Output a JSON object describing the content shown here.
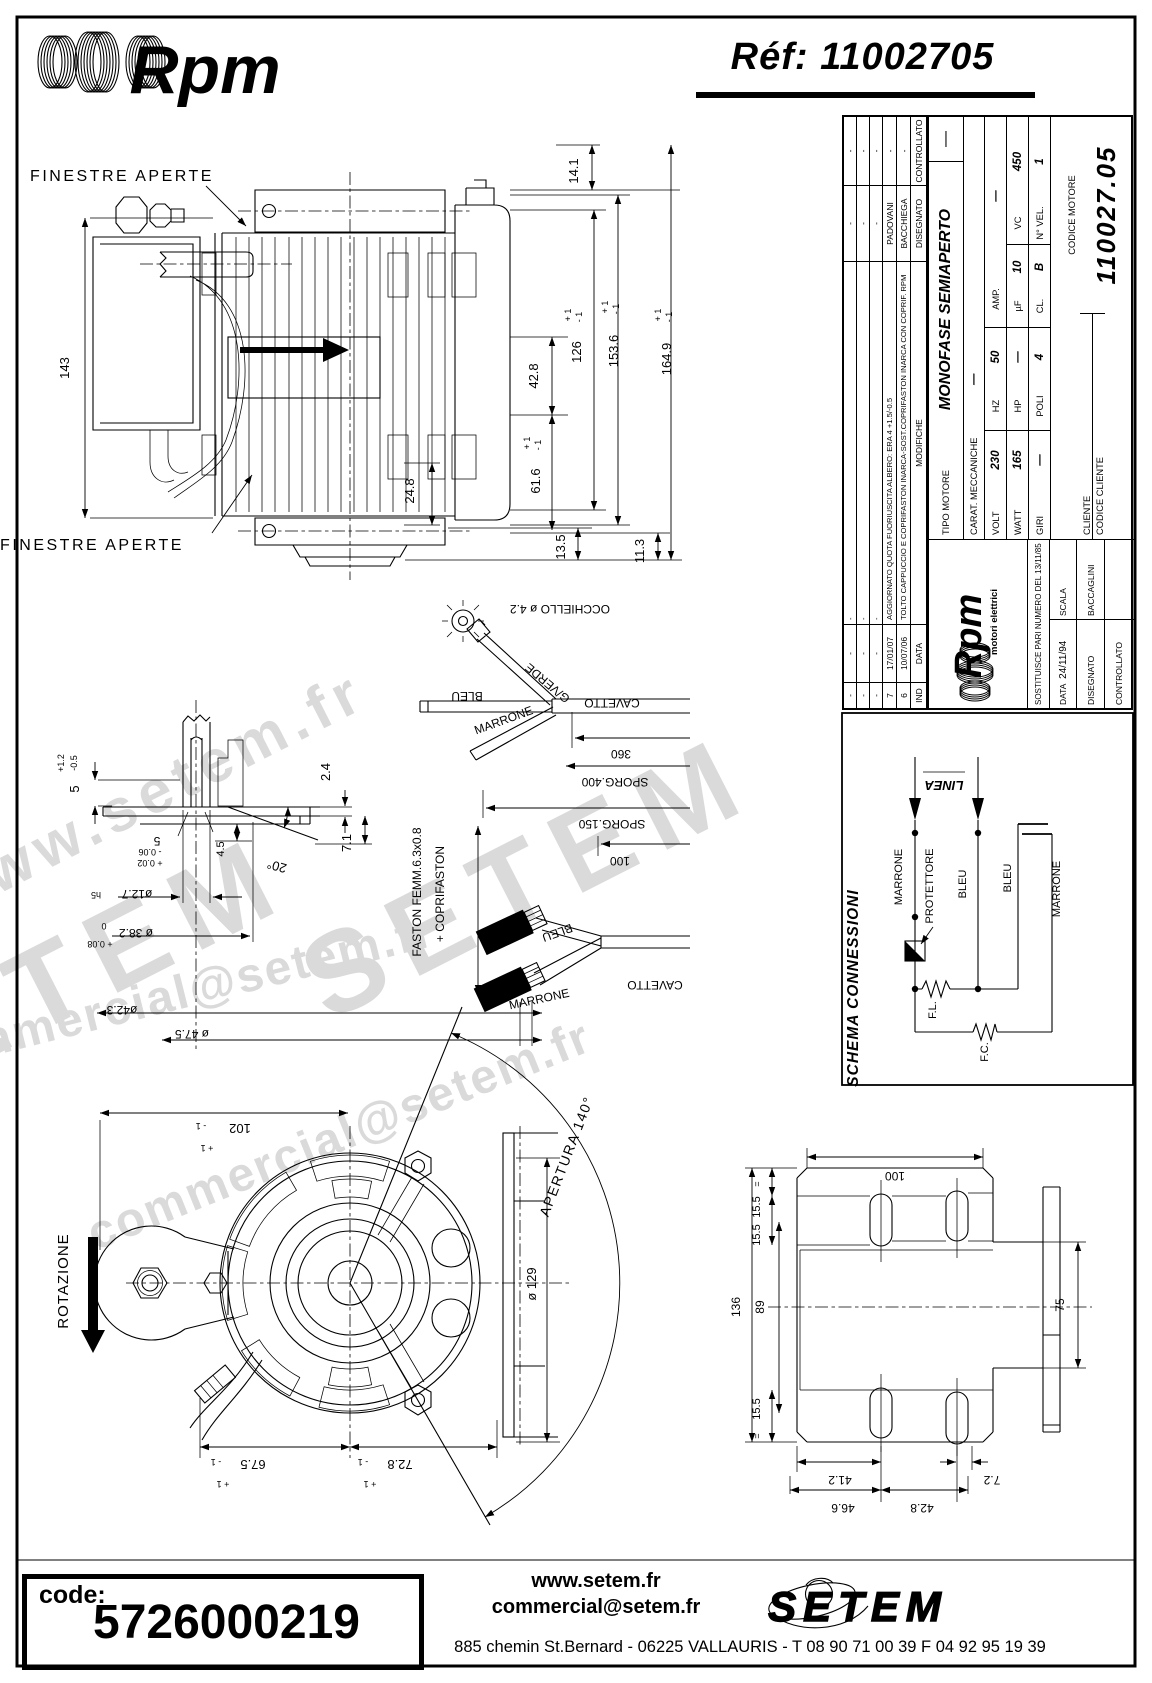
{
  "header": {
    "brand": "Rpm",
    "ref": "Réf:  11002705"
  },
  "watermarks": {
    "w1": "www.setem.fr",
    "w2": "SETEM",
    "w3": "SETEM",
    "w4": "commercial@setem.fr",
    "w5": "commercial@setem.fr"
  },
  "title_block": {
    "revisions": {
      "header": {
        "ind": "IND",
        "data": "DATA",
        "modifiche": "MODIFICHE",
        "disegnato": "DISEGNATO",
        "controllato": "CONTROLLATO"
      },
      "rows": [
        {
          "ind": "-",
          "data": "-",
          "modifiche": "-",
          "disegnato": "-",
          "controllato": "-"
        },
        {
          "ind": "-",
          "data": "-",
          "modifiche": "-",
          "disegnato": "-",
          "controllato": "-"
        },
        {
          "ind": "-",
          "data": "-",
          "modifiche": "-",
          "disegnato": "-",
          "controllato": "-"
        },
        {
          "ind": "7",
          "data": "17/01/07",
          "modifiche": "AGGIORNATO QUOTA FUORIUSCITA ALBERO:  ERA 4 +1.5/-0.5",
          "disegnato": "PADOVANI",
          "controllato": "-"
        },
        {
          "ind": "6",
          "data": "10/07/06",
          "modifiche": "TOLTO CAPPUCCIO E COPRIFASTON INARCA-SOST.COPRIFASTON INARCA CON COPRIF. RPM",
          "disegnato": "BACCHIEGA",
          "controllato": "-"
        }
      ]
    },
    "logo": {
      "brand": "Rpm",
      "sub": "motori elettrici"
    },
    "tipo_label": "TIPO MOTORE",
    "tipo_value": "MONOFASE SEMIAPERTO",
    "tipo_note": "—",
    "carat_label": "CARAT. MECCANICHE",
    "carat_value": "—",
    "volt_label": "VOLT",
    "volt": "230",
    "hz_label": "HZ",
    "hz": "50",
    "amp_label": "AMP.",
    "amp": "—",
    "watt_label": "WATT",
    "watt": "165",
    "hp_label": "HP",
    "hp": "—",
    "uf_label": "µF",
    "uf": "10",
    "vc_label": "VC",
    "vc": "450",
    "giri_label": "GIRI",
    "giri": "—",
    "poli_label": "POLI",
    "poli": "4",
    "cl_label": "CL.",
    "cl": "B",
    "nvel_label": "N° VEL.",
    "nvel": "1",
    "cliente_label": "CLIENTE",
    "codice_cliente_label": "CODICE CLIENTE",
    "codice_motore_label": "CODICE MOTORE",
    "codice_motore": "110027.05",
    "sostituisce": "SOSTITUISCE PARI NUMERO DEL 13/11/85",
    "data_label": "DATA",
    "data_value": "24/11/94",
    "scala_label": "SCALA",
    "disegnato_label": "DISEGNATO",
    "disegnato_value": "BACCAGLINI",
    "controllato_label": "CONTROLLATO"
  },
  "schema": {
    "title": "SCHEMA CONNESSIONI",
    "linea": "LINEA",
    "marrone1": "MARRONE",
    "bleu1": "BLEU",
    "protettore": "PROTETTORE",
    "fl": "F.L.",
    "fc": "F.C.",
    "bleu2": "BLEU",
    "marrone2": "MARRONE"
  },
  "side_view": {
    "finestre_top": "FINESTRE APERTE",
    "finestre_bottom": "FINESTRE APERTE",
    "d143": "143",
    "d24_8": "24.8",
    "d14_1": "14.1",
    "d42_8": "42.8",
    "d126": "126",
    "d153_6": "153.6",
    "d164_9": "164.9",
    "d61_6": "61.6",
    "d13_5": "13.5",
    "d11_3": "11.3",
    "tol_p1": "+ 1",
    "tol_m1": "- 1"
  },
  "shaft_detail": {
    "d2_4": "2.4",
    "d7_1": "7.1",
    "d4_5": "4.5",
    "d5a": "5",
    "d5a_tp": "+1.2",
    "d5a_tm": "-0.5",
    "d20": "20°",
    "d5b": "5",
    "d5b_tm": "- 0.06",
    "d5b_tp": "+ 0.02",
    "d12_7": "ø12.7",
    "d12_7_suffix": "h5",
    "d38_2": "ø 38.2",
    "d38_2_t0": "0",
    "d38_2_t8": "+ 0.08",
    "d42_3": "ø42.3",
    "d47_5": "ø 47.5"
  },
  "cables": {
    "occhiello": "OCCHIELLO ø 4.2",
    "gverde": "G/VERDE",
    "bleu_a": "BLEU",
    "marrone_a": "MARRONE",
    "cavetto_a": "CAVETTO",
    "d360": "360",
    "sporg400": "SPORG.400",
    "sporg150": "SPORG.150",
    "d100": "100",
    "bleu_b": "BLEU",
    "marrone_b": "MARRONE",
    "cavetto_b": "CAVETTO",
    "faston1": "FASTON FEMM.6.3x0.8",
    "faston2": "+ COPRIFASTON"
  },
  "front_view": {
    "rotazione": "ROTAZIONE",
    "apertura": "APERTURA 140°",
    "d102": "102",
    "d129": "ø 129",
    "d67_5": "67.5",
    "d72_8": "72.8",
    "tol_p1": "+ 1",
    "tol_m1": "- 1"
  },
  "bracket": {
    "d100": "100",
    "d136": "136",
    "d89": "89",
    "d15_5a": "15.5",
    "d15_5b": "15.5",
    "d15_5c": "15.5",
    "eq": "=",
    "d75": "75",
    "d41_2": "41.2",
    "d46_6": "46.6",
    "d42_8": "42.8",
    "d7_2": "7.2"
  },
  "footer": {
    "code_label": "code:",
    "code_value": "5726000219",
    "website": "www.setem.fr",
    "email": "commercial@setem.fr",
    "address": "885 chemin St.Bernard  -  06225 VALLAURIS  -  T 08 90 71 00 39   F 04 92 95 19 39",
    "brand": "SETEM"
  }
}
